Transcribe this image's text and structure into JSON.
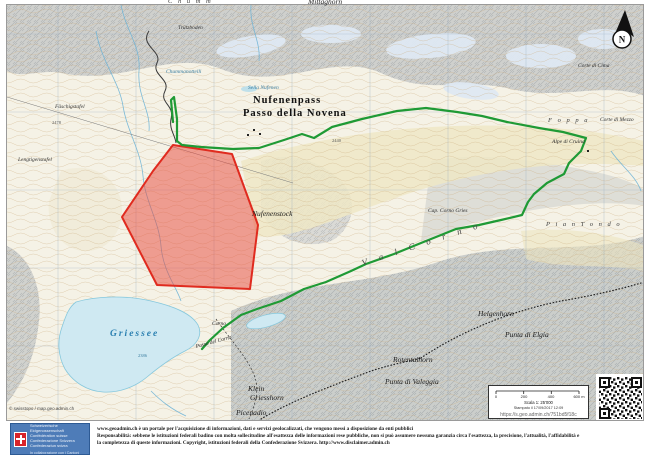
{
  "map": {
    "attribution": "© swisstopo / map.geo.admin.ch",
    "north_label": "N",
    "colors": {
      "restriction_fill": "#e8453a",
      "restriction_stroke": "#e02b1f",
      "route": "#1f9a35",
      "lake": "#cfe9f2",
      "lake_stroke": "#86c8dd"
    },
    "red_polygon_points": "172,144 231,153 257,224 249,288 156,284 121,216 152,170",
    "green_route_points": "172,121 170,99 173,96 176,118 176,140 181,144 200,146 232,148 258,147 283,139 301,133 313,137 331,126 361,118 396,110 425,107 456,111 481,115 506,121 538,127 562,131 585,137 580,150 568,162 563,173 546,182 533,193 527,201 521,214 500,219 478,224 455,228 420,242 393,253 365,263 350,270 325,281 303,288 280,300 256,308 240,314 222,327 209,339 201,348",
    "lake_path": "M75,301 C95,295 125,294 150,300 C172,305 190,312 197,324 C202,334 196,344 184,350 C170,357 158,366 146,376 C134,386 118,392 102,391 C86,390 72,381 64,368 C57,355 56,340 61,326 C65,314 68,306 75,301 Z",
    "labels": [
      {
        "text": "C h u m m",
        "x": 168,
        "y": -2,
        "cls": "terrain-sp"
      },
      {
        "text": "Mittaghorn",
        "x": 308,
        "y": -3,
        "cls": "peak2"
      },
      {
        "text": "Trützboden",
        "x": 178,
        "y": 25,
        "cls": "minor"
      },
      {
        "text": "Chummanottelli",
        "x": 166,
        "y": 69,
        "cls": "minor-blue"
      },
      {
        "text": "Fäschigstafel",
        "x": 55,
        "y": 104,
        "cls": "minor"
      },
      {
        "text": "Lengtigenstafel",
        "x": 18,
        "y": 157,
        "cls": "minor"
      },
      {
        "text": "Sella Nufenen",
        "x": 248,
        "y": 85,
        "cls": "minor-blue"
      },
      {
        "text": "Nufenenpass",
        "x": 253,
        "y": 95,
        "cls": "pass"
      },
      {
        "text": "Passo della Novena",
        "x": 243,
        "y": 108,
        "cls": "pass"
      },
      {
        "text": "Nufenenstock",
        "x": 252,
        "y": 209,
        "cls": "peak2"
      },
      {
        "text": "2440",
        "x": 332,
        "y": 138,
        "cls": "elev"
      },
      {
        "text": "2478",
        "x": 52,
        "y": 120,
        "cls": "elev"
      },
      {
        "text": "Griessee",
        "x": 110,
        "y": 329,
        "cls": "lake-label"
      },
      {
        "text": "2386",
        "x": 138,
        "y": 353,
        "cls": "elev-blue"
      },
      {
        "text": "Corte di Cima",
        "x": 578,
        "y": 63,
        "cls": "minor-i"
      },
      {
        "text": "Corte di Mezzo",
        "x": 600,
        "y": 117,
        "cls": "minor-i"
      },
      {
        "text": "F o p p a",
        "x": 548,
        "y": 117,
        "cls": "terrain-sp"
      },
      {
        "text": "Alpe di Cruina",
        "x": 552,
        "y": 139,
        "cls": "minor-i"
      },
      {
        "text": "Cap. Corno Gries",
        "x": 428,
        "y": 208,
        "cls": "minor-i"
      },
      {
        "text": "P i a n   T o n d o",
        "x": 546,
        "y": 221,
        "cls": "terrain-sp"
      },
      {
        "text": "V a l   C o r n o",
        "x": 362,
        "y": 258,
        "cls": "valley",
        "rot": -18
      },
      {
        "text": "Corno",
        "x": 212,
        "y": 321,
        "cls": "minor-i"
      },
      {
        "text": "Passo del Corno",
        "x": 196,
        "y": 344,
        "cls": "minor-i",
        "rot": -15
      },
      {
        "text": "Helgenhorn",
        "x": 478,
        "y": 309,
        "cls": "peak2"
      },
      {
        "text": "Punta di Elgia",
        "x": 505,
        "y": 330,
        "cls": "peak2"
      },
      {
        "text": "Rotentalhorn",
        "x": 393,
        "y": 355,
        "cls": "peak2"
      },
      {
        "text": "Punta di Valeggia",
        "x": 385,
        "y": 377,
        "cls": "peak2"
      },
      {
        "text": "Klein",
        "x": 248,
        "y": 384,
        "cls": "peak2"
      },
      {
        "text": "Griesshorn",
        "x": 250,
        "y": 393,
        "cls": "peak2"
      },
      {
        "text": "Picenadio",
        "x": 236,
        "y": 408,
        "cls": "peak2"
      }
    ]
  },
  "scale_box": {
    "ticks": [
      "0",
      "200",
      "400",
      "600 m"
    ],
    "scale_text": "Scala 1: 25'000",
    "printed_text": "Stampato il 17/09/2017 12:09",
    "short_link": "https://s.geo.admin.ch/751bd5f18c"
  },
  "footer": {
    "logo_lines": [
      "Schweizerische Eidgenossenschaft",
      "Confédération suisse",
      "Confederazione Svizzera",
      "Confederaziun svizra"
    ],
    "logo_sub": "In collaborazione con i Cantoni",
    "disclaimer_lines": [
      "www.geoadmin.ch è un portale per l'acquisizione di informazioni, dati e servizi geolocalizzati, che vengono messi a disposizione da enti pubblici",
      "Responsabilità: sebbene le istituzioni federali badino con molta sollecitudine all'esattezza delle informazioni rese pubbliche, non si può assumere nessuna garanzia circa l'esattezza, la precisione, l'attualità, l'affidabilità e",
      "la completezza di queste informazioni. Copyright, istituzioni federali della Confederazione Svizzera. http://www.disclaimer.admin.ch"
    ]
  }
}
